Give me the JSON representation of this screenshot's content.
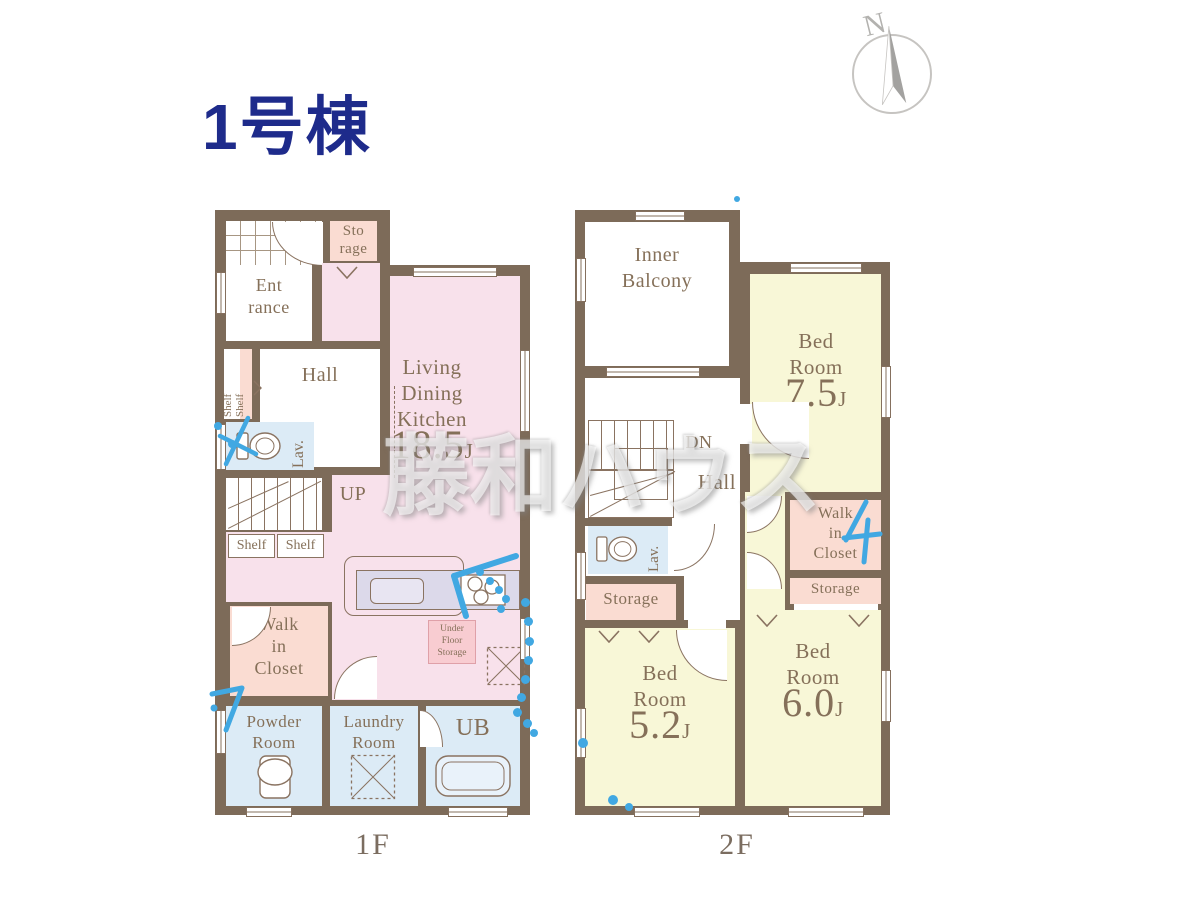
{
  "title": "1号棟",
  "compass": {
    "label": "N"
  },
  "watermark": "藤和ハウス",
  "colors": {
    "wall": "#7d6b59",
    "ldk_pink": "#f8e1eb",
    "closet_pink": "#fadcd2",
    "bedroom_yellow": "#f8f7d7",
    "water_blue": "#dcebf6",
    "counter_lavender": "#dcd9ea",
    "label_brown": "#857059",
    "title_navy": "#1e2b8b",
    "annotation_blue": "#41a8e2"
  },
  "floor1": {
    "caption": "1F",
    "storage": [
      "Sto",
      "rage"
    ],
    "entrance": [
      "Ent",
      "rance"
    ],
    "shelf_left_a": "Shelf",
    "shelf_left_b": "Shelf",
    "hall": "Hall",
    "lav": "Lav.",
    "up": "UP",
    "shelf_box_a": "Shelf",
    "shelf_box_b": "Shelf",
    "ldk": {
      "lines": [
        "Living",
        "Dining",
        "Kitchen"
      ],
      "size": "18.5",
      "unit": "J"
    },
    "under_floor_storage": [
      "Under",
      "Floor",
      "Storage"
    ],
    "walk_in_closet": [
      "Walk",
      "in",
      "Closet"
    ],
    "powder_room": [
      "Powder",
      "Room"
    ],
    "laundry_room": [
      "Laundry",
      "Room"
    ],
    "ub": "UB"
  },
  "floor2": {
    "caption": "2F",
    "inner_balcony": [
      "Inner",
      "Balcony"
    ],
    "bedroom1": {
      "lines": [
        "Bed",
        "Room"
      ],
      "size": "7.5",
      "unit": "J"
    },
    "dn": "DN",
    "hall": "Hall",
    "lav": "Lav.",
    "storage_left": "Storage",
    "walk_in_closet": [
      "Walk",
      "in",
      "Closet"
    ],
    "storage_right": "Storage",
    "bedroom2": {
      "lines": [
        "Bed",
        "Room"
      ],
      "size": "5.2",
      "unit": "J"
    },
    "bedroom3": {
      "lines": [
        "Bed",
        "Room"
      ],
      "size": "6.0",
      "unit": "J"
    }
  }
}
